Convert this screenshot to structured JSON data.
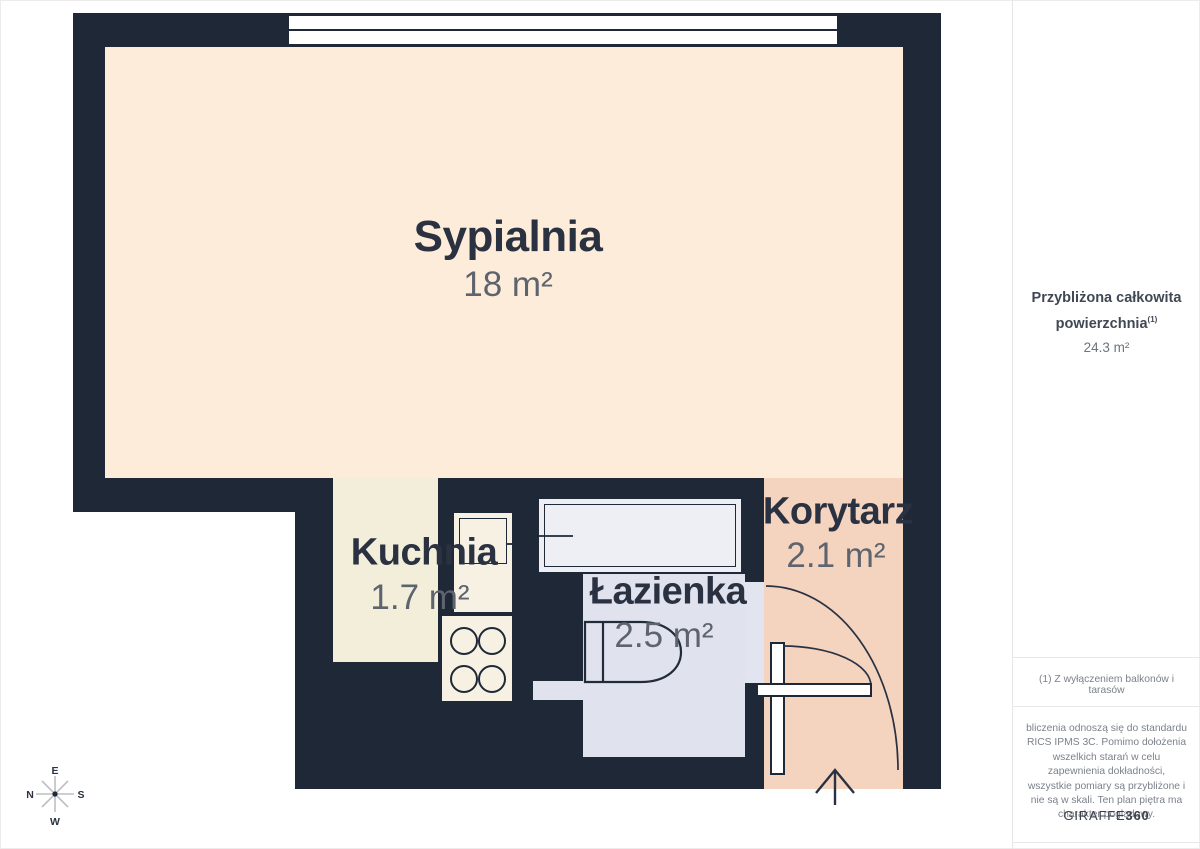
{
  "plan": {
    "rooms": [
      {
        "name": "Sypialnia",
        "area": "18 m²"
      },
      {
        "name": "Kuchnia",
        "area": "1.7 m²"
      },
      {
        "name": "Łazienka",
        "area": "2.5 m²"
      },
      {
        "name": "Korytarz",
        "area": "2.1 m²"
      }
    ],
    "compass": {
      "top": "E",
      "left": "N",
      "right": "S",
      "bottom": "W"
    }
  },
  "sidebar": {
    "total_label": "Przybliżona całkowita powierzchnia",
    "total_footnote_marker": "(1)",
    "total_value": "24.3 m²",
    "footnote": "(1) Z wyłączeniem balkonów i tarasów",
    "disclaimer": "bliczenia odnoszą się do standardu RICS IPMS 3C. Pomimo dołożenia wszelkich starań w celu zapewnienia dokładności, wszystkie pomiary są przybliżone i nie są w skali. Ten plan piętra ma charakter poglądowy.",
    "brand_regular": "GIRAFFE",
    "brand_bold": "360"
  },
  "colors": {
    "wall": "#1f2836",
    "bedroom_floor": "#fcecd9",
    "kitchen_floor": "#f3eeda",
    "bathroom_floor": "#e0e3ee",
    "bathtub_fill": "#edeff5",
    "corridor_floor": "#f4d3bf",
    "fixture_fill": "#f6f1e3",
    "label_text": "#2a3242",
    "area_text": "#5d646e"
  }
}
